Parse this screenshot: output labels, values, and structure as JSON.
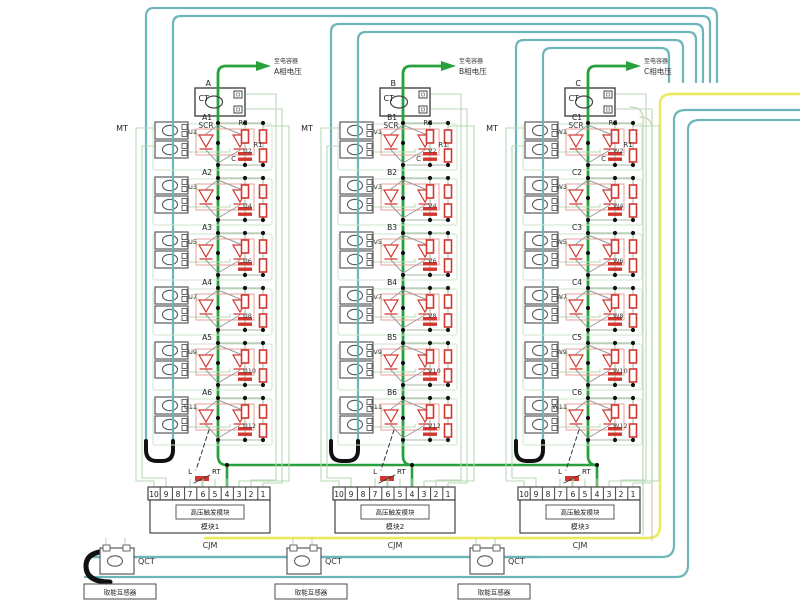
{
  "diagram": {
    "kind": "thyristor-valve-three-phase-schematic",
    "labels": {
      "ct": "CT",
      "mt": "MT",
      "scr": "SCR",
      "r2": "R2",
      "r1": "R1",
      "cap": "C",
      "l": "L",
      "rt": "RT",
      "qct": "QCT",
      "cjm": "CJM"
    },
    "terminals": [
      "10",
      "9",
      "8",
      "7",
      "6",
      "5",
      "4",
      "3",
      "2",
      "1"
    ],
    "phases": [
      {
        "id": "A",
        "top_node": "A",
        "arrow_line1": "至电容器",
        "arrow_line2": "A相电压",
        "nodes": [
          "A1",
          "A2",
          "A3",
          "A4",
          "A5",
          "A6"
        ],
        "thyristors": [
          "U1",
          "U2",
          "U3",
          "U4",
          "U5",
          "U6",
          "U7",
          "U8",
          "U9",
          "U10",
          "U11",
          "U12"
        ],
        "module_inner": "高压触发模块",
        "module_label": "模块1"
      },
      {
        "id": "B",
        "top_node": "B",
        "arrow_line1": "至电容器",
        "arrow_line2": "B相电压",
        "nodes": [
          "B1",
          "B2",
          "B3",
          "B4",
          "B5",
          "B6"
        ],
        "thyristors": [
          "V1",
          "V2",
          "V3",
          "V4",
          "V5",
          "V6",
          "V7",
          "V8",
          "V9",
          "V10",
          "V11",
          "V12"
        ],
        "module_inner": "高压触发模块",
        "module_label": "模块2"
      },
      {
        "id": "C",
        "top_node": "C",
        "arrow_line1": "至电容器",
        "arrow_line2": "C相电压",
        "nodes": [
          "C1",
          "C2",
          "C3",
          "C4",
          "C5",
          "C6"
        ],
        "thyristors": [
          "W1",
          "W2",
          "W3",
          "W4",
          "W5",
          "W6",
          "W7",
          "W8",
          "W9",
          "W10",
          "W11",
          "W12"
        ],
        "module_inner": "高压触发模块",
        "module_label": "模块3"
      }
    ],
    "bottom_boxes": [
      "取能互感器",
      "取能互感器",
      "取能互感器"
    ],
    "colors": {
      "teal": "#6cb6ba",
      "green_thick": "#28a03c",
      "pale_wire": "#b9dab4",
      "wire_gray": "#9fb89f",
      "yellow": "#ece957",
      "red": "#d23730",
      "pink": "#eaa09a",
      "black": "#111111",
      "box_border": "#5a5a5a",
      "ct_border": "#444444",
      "text": "#333333",
      "olive_wire": "#cdcdb0"
    }
  }
}
